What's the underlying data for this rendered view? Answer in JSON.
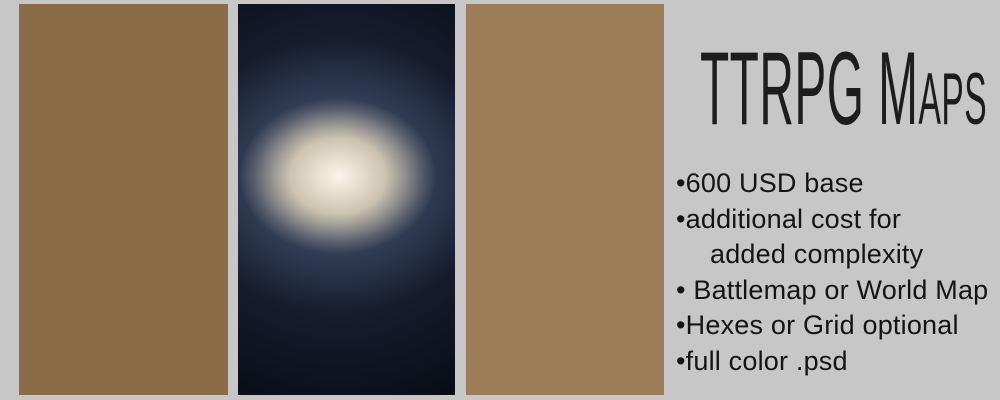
{
  "background_color": "#c7c7c7",
  "title": "TTRPG Maps",
  "pricing": {
    "bullet_char": "•",
    "items": [
      {
        "lines": [
          "600 USD base"
        ]
      },
      {
        "lines": [
          "additional cost for",
          "added complexity"
        ]
      },
      {
        "lines": [
          " Battlemap or World Map"
        ]
      },
      {
        "lines": [
          "Hexes or Grid optional"
        ]
      },
      {
        "lines": [
          "full color .psd"
        ]
      }
    ]
  },
  "fantasy_map": {
    "labels": [
      {
        "text": "Magma Caverns",
        "x": 42,
        "y": 37,
        "size": 9,
        "ls": 1.2
      },
      {
        "text": "apul",
        "x": 12,
        "y": 63,
        "size": 13,
        "ls": 1,
        "italic": true,
        "rot": -12
      },
      {
        "text": "Castle Labria",
        "x": 85,
        "y": 76,
        "size": 8.5,
        "ls": 1
      },
      {
        "text": "Lauda Desert",
        "x": 92,
        "y": 124,
        "size": 11.5,
        "ls": 2
      },
      {
        "text": "Mount Tivoli",
        "x": 97,
        "y": 154,
        "size": 9,
        "ls": 1.5
      },
      {
        "text": "Mordria",
        "x": 56,
        "y": 211,
        "size": 25,
        "ls": 2,
        "bold": true
      },
      {
        "text": "Mysterious Crater",
        "x": 32,
        "y": 260,
        "size": 9,
        "ls": 1
      },
      {
        "text": "War Camp",
        "x": 90,
        "y": 275,
        "size": 10,
        "ls": 1.5
      },
      {
        "text": "Gulf of",
        "x": 184,
        "y": 289,
        "size": 10.5,
        "ls": 1.5
      },
      {
        "text": "Halzall Lake",
        "x": 168,
        "y": 350,
        "size": 6.5,
        "ls": 0.5
      }
    ],
    "pins": [
      [
        42,
        68
      ],
      [
        47,
        244
      ],
      [
        108,
        258
      ],
      [
        165,
        6
      ],
      [
        62,
        7
      ]
    ],
    "colors": {
      "sea": "#8a6c46",
      "forest": "#9ccb82",
      "pine": "#3f5a2f",
      "desert": "#e09a79",
      "gray": "#9b9b9d",
      "magenta": "#d173ae",
      "gulf": "#7c6733",
      "ink": "#33200f",
      "river": "#4a2e14",
      "mtn": "#a06a45",
      "patch": "#7a9a5a"
    }
  },
  "galaxy_map": {
    "labels": [
      {
        "text": "Helvel",
        "tx": 145,
        "ty": 15,
        "bar": [
          118,
          196,
          17
        ],
        "box": [
          122,
          21,
          46,
          19
        ],
        "stripes": 2,
        "callout": [
          118,
          17,
          84,
          33
        ]
      },
      {
        "text": "Betega",
        "tx": 8,
        "ty": 57,
        "bar": [
          0,
          46,
          61
        ],
        "box": [
          0,
          64,
          37,
          18
        ],
        "stripes": 2,
        "callout": [
          46,
          61,
          54,
          93
        ]
      },
      {
        "text": "Ioamakos",
        "tx": 74,
        "ty": 79,
        "bar": [
          63,
          118,
          83
        ],
        "box": [
          70,
          86,
          47,
          15
        ],
        "stripes": 2,
        "callout": [
          63,
          83,
          57,
          94
        ]
      },
      {
        "text": "Arla",
        "tx": 18,
        "ty": 152,
        "bar": [
          0,
          54,
          156
        ],
        "box": [
          0,
          159,
          36,
          17
        ],
        "stripes": 3,
        "callout": [
          54,
          156,
          96,
          171
        ]
      },
      {
        "text": "Yggdrasil",
        "tx": 36,
        "ty": 192,
        "bar": [
          28,
          106,
          196
        ],
        "box": [
          44,
          199,
          60,
          30
        ],
        "stripes": 3,
        "callout": [
          106,
          196,
          100,
          177
        ]
      },
      {
        "text": "Thorunn",
        "tx": 92,
        "ty": 227,
        "bar": [
          77,
          148,
          231
        ],
        "box": [
          78,
          234,
          38,
          26
        ],
        "stripes": 4,
        "callout": [
          77,
          231,
          61,
          240
        ]
      },
      {
        "text": "Ordano",
        "tx": 2,
        "ty": 253,
        "bar": [
          0,
          52,
          257
        ],
        "box": [
          0,
          261,
          34,
          14
        ],
        "stripes": 2,
        "callout": [
          52,
          257,
          58,
          246
        ]
      },
      {
        "text": "Scara",
        "tx": 62,
        "ty": 302,
        "bar": [
          44,
          98,
          306
        ],
        "box": [
          47,
          309,
          40,
          22
        ],
        "stripes": 4,
        "callout": [
          44,
          306,
          28,
          315
        ]
      },
      {
        "text": "Mardle",
        "tx": 168,
        "ty": 287,
        "bar": [
          151,
          212,
          291
        ],
        "box": [
          155,
          294,
          42,
          16
        ],
        "stripes": 2,
        "callout": [
          151,
          291,
          139,
          299
        ]
      },
      {
        "text": "Lorinen",
        "tx": 126,
        "ty": 327,
        "bar": [
          99,
          168,
          331
        ],
        "box": [
          104,
          334,
          46,
          20
        ],
        "stripes": 3,
        "callout": [
          99,
          331,
          96,
          338
        ]
      }
    ],
    "edge_boxes": [
      [
        198,
        62,
        19,
        16
      ],
      [
        198,
        128,
        19,
        12
      ],
      [
        188,
        358,
        29,
        16
      ]
    ],
    "nodes": [
      [
        84,
        33
      ],
      [
        55,
        97
      ],
      [
        165,
        90
      ],
      [
        100,
        175
      ],
      [
        175,
        143
      ],
      [
        191,
        152
      ],
      [
        60,
        241
      ],
      [
        177,
        243
      ],
      [
        26,
        317
      ],
      [
        94,
        340
      ],
      [
        137,
        300
      ],
      [
        186,
        344
      ]
    ],
    "edges": [
      [
        0,
        1
      ],
      [
        0,
        2
      ],
      [
        1,
        3
      ],
      [
        3,
        2
      ],
      [
        3,
        4
      ],
      [
        3,
        6
      ],
      [
        3,
        7
      ],
      [
        3,
        9
      ],
      [
        4,
        5
      ],
      [
        6,
        8
      ],
      [
        8,
        9
      ],
      [
        9,
        11
      ],
      [
        10,
        11
      ],
      [
        7,
        10
      ],
      [
        7,
        11
      ]
    ],
    "stubs": [
      [
        0,
        14,
        0
      ],
      [
        1,
        0,
        126
      ],
      [
        2,
        217,
        48
      ],
      [
        5,
        217,
        142
      ],
      [
        6,
        0,
        270
      ],
      [
        8,
        0,
        300
      ],
      [
        9,
        70,
        390
      ],
      [
        11,
        217,
        334
      ],
      [
        7,
        217,
        208
      ]
    ],
    "colors": {
      "line": "#f2a3ab",
      "line_bright": "#ffd2d6",
      "node": "#e8941f",
      "cyan": "#2fd8e8",
      "label_text": "#aef4fa",
      "box": "rgba(30,125,150,0.52)",
      "box_edge": "rgba(90,205,225,0.4)",
      "stripe": "rgba(150,238,248,0.8)"
    }
  },
  "hex_map": {
    "colors": {
      "wood": "#9c7d58",
      "wood_dark": "#7d6242",
      "corridor": "#b4652c",
      "corridor_dark": "#8a4a1c",
      "stone": "#8f8f8f",
      "stone_dark": "#666666",
      "terracotta": "#bf6a33",
      "terracotta_dark": "#96491e",
      "hexline": "rgba(242,235,220,0.5)",
      "frame": "#a85a20",
      "crate": "#1c1c1c",
      "table": "#6b4526",
      "table_top": "#7d5530",
      "chair": "#2a2a2a",
      "bed": "#7c4f2c",
      "counter": "#e9e4d4",
      "barrel": "#925f2a",
      "shelf": "#5f4128",
      "block": "#3c3c3c"
    }
  }
}
